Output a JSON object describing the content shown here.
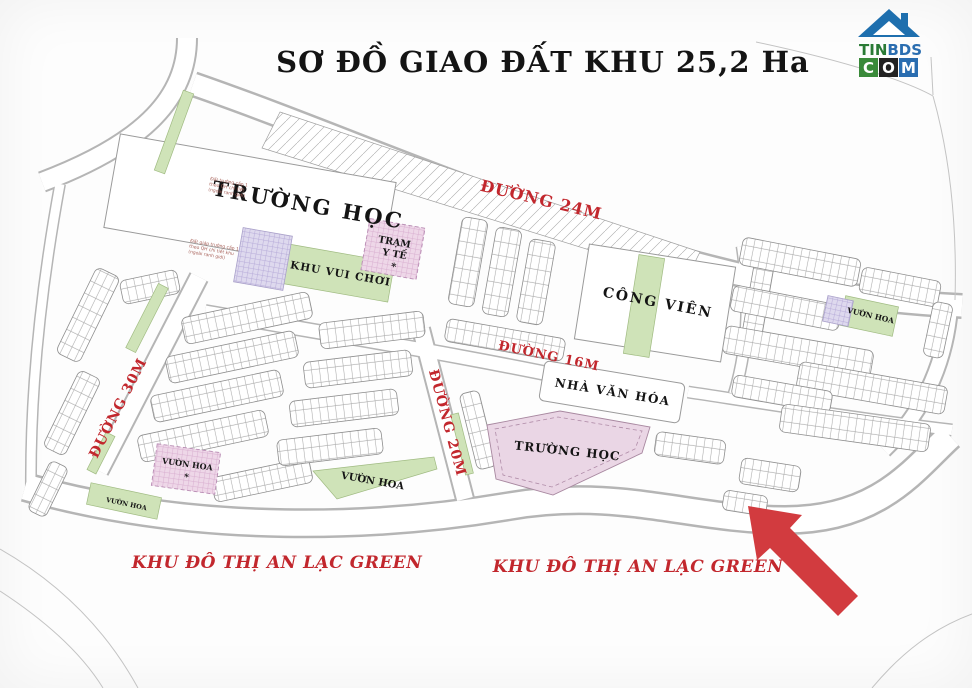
{
  "title": "SƠ ĐỒ GIAO ĐẤT KHU 25,2 Ha",
  "logo": {
    "tin": "TIN",
    "bds": "BDS",
    "c": "C",
    "o": "O",
    "m": "M"
  },
  "roads": {
    "d24": "ĐƯỜNG 24M",
    "d16": "ĐƯỜNG 16M",
    "d30": "ĐƯỜNG 30M",
    "d20": "ĐƯỜNG 20M"
  },
  "areas": {
    "school": "TRƯỜNG HỌC",
    "park": "CÔNG VIÊN",
    "culture": "NHÀ VĂN HÓA",
    "playground": "KHU VUI CHƠI",
    "medical1": "TRẠM",
    "medical2": "Y TẾ",
    "garden": "VƯỜN HOA",
    "marker": "*"
  },
  "captions": {
    "urban": "KHU ĐÔ THỊ AN LẠC GREEN"
  },
  "notes": {
    "n1": [
      "Đất trường cấp 1",
      "theo QH chi tiết",
      "(ngoài ranh giới)"
    ],
    "n2": [
      "Đất giáp trường cấp 1",
      "theo QH chi tiết khu",
      "(ngoài ranh giới)"
    ]
  }
}
